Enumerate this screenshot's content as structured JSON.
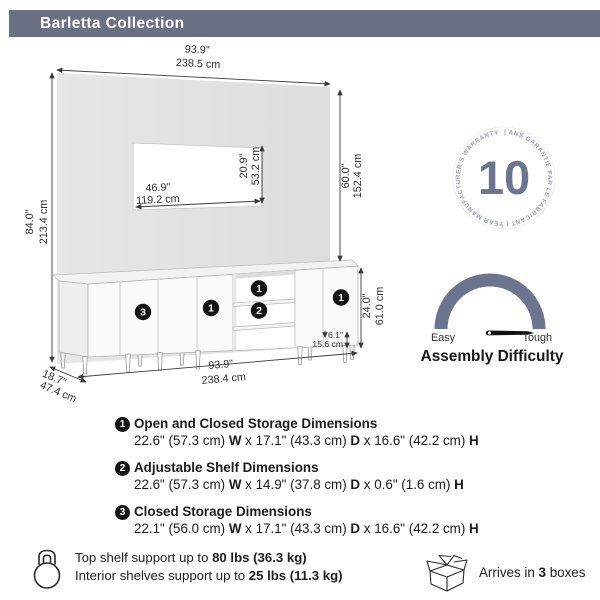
{
  "header": {
    "title": "Barletta Collection"
  },
  "colors": {
    "header_bg": "#6a7183",
    "accent_slate": "#6b7590",
    "callout_black": "#141414",
    "panel_gray": "#e3e3e3"
  },
  "icons": {
    "support": "kettlebell-icon",
    "shipping": "open-box-icon",
    "warranty": "circular-warranty-badge",
    "difficulty": "semicircle-gauge-icon"
  },
  "diagram": {
    "overall_width": {
      "in": "93.9\"",
      "cm": "238.5 cm"
    },
    "overall_height": {
      "in": "84.0\"",
      "cm": "213.4 cm"
    },
    "panel_height": {
      "in": "60.0\"",
      "cm": "152.4 cm"
    },
    "tv_opening_width": {
      "in": "46.9\"",
      "cm": "119.2 cm"
    },
    "tv_opening_height": {
      "in": "20.9\"",
      "cm": "53.2 cm"
    },
    "console_height": {
      "in": "24.0\"",
      "cm": "61.0 cm"
    },
    "leg_height": {
      "in": "6.1\"",
      "cm": "15.6 cm"
    },
    "console_width": {
      "in": "93.9\"",
      "cm": "238.4 cm"
    },
    "depth": {
      "in": "18.7\"",
      "cm": "47.4 cm"
    },
    "callouts": {
      "one": "1",
      "two": "2",
      "three": "3"
    }
  },
  "warranty_badge": {
    "number": "10",
    "ring_text": "| ANS GARANTIE PAR LE FABRICANT | YEAR MANUFACTURER'S WARRANTY "
  },
  "difficulty": {
    "easy": "Easy",
    "tough": "Tough",
    "label": "Assembly Difficulty"
  },
  "specs": [
    {
      "num": "1",
      "title": "Open and Closed Storage Dimensions",
      "segments": [
        {
          "t": "22.6\" (57.3 cm) ",
          "b": false
        },
        {
          "t": "W",
          "b": true
        },
        {
          "t": " x 17.1\" (43.3 cm) ",
          "b": false
        },
        {
          "t": "D",
          "b": true
        },
        {
          "t": " x 16.6\" (42.2 cm) ",
          "b": false
        },
        {
          "t": "H",
          "b": true
        }
      ]
    },
    {
      "num": "2",
      "title": "Adjustable Shelf Dimensions",
      "segments": [
        {
          "t": "22.6\" (57.3 cm) ",
          "b": false
        },
        {
          "t": "W",
          "b": true
        },
        {
          "t": " x 14.9\" (37.8 cm) ",
          "b": false
        },
        {
          "t": "D",
          "b": true
        },
        {
          "t": " x 0.6\" (1.6 cm) ",
          "b": false
        },
        {
          "t": "H",
          "b": true
        }
      ]
    },
    {
      "num": "3",
      "title": "Closed Storage Dimensions",
      "segments": [
        {
          "t": "22.1\" (56.0 cm) ",
          "b": false
        },
        {
          "t": "W",
          "b": true
        },
        {
          "t": " x 17.1\" (43.3 cm) ",
          "b": false
        },
        {
          "t": "D",
          "b": true
        },
        {
          "t": " x 16.6\" (42.2 cm) ",
          "b": false
        },
        {
          "t": "H",
          "b": true
        }
      ]
    }
  ],
  "support": {
    "line1": [
      {
        "t": "Top shelf support up to ",
        "b": false
      },
      {
        "t": "80 lbs (36.3 kg)",
        "b": true
      }
    ],
    "line2": [
      {
        "t": "Interior shelves support up to ",
        "b": false
      },
      {
        "t": "25 lbs (11.3 kg)",
        "b": true
      }
    ]
  },
  "shipping": [
    {
      "t": "Arrives in ",
      "b": false
    },
    {
      "t": "3",
      "b": true
    },
    {
      "t": " boxes",
      "b": false
    }
  ]
}
